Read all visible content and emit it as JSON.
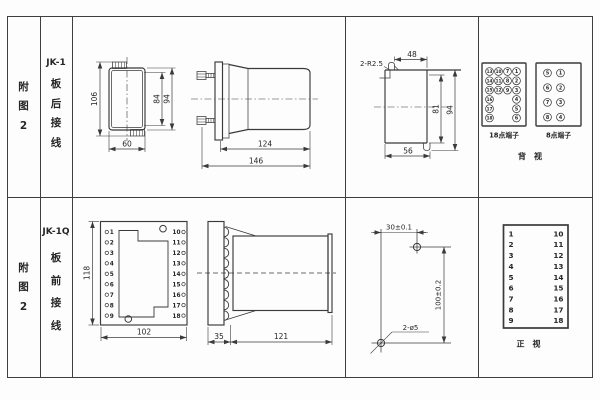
{
  "figure": {
    "row_top": {
      "index_label": [
        "附",
        "图",
        "2"
      ],
      "model": "JK-1",
      "wiring": [
        "板",
        "后",
        "接",
        "线"
      ],
      "rear_view": {
        "dim_total_h": "106",
        "dim_w": "60",
        "dim_inner_h": "84",
        "dim_case_h": "94"
      },
      "side_view": {
        "dim_depth": "124",
        "dim_total": "146"
      },
      "profile": {
        "radius": "2-R2.5",
        "dim_top": "48",
        "dim_inner": "81",
        "dim_outer": "94",
        "dim_bottom": "56"
      },
      "terminal18": {
        "label": "18点端子",
        "col0": [
          "13",
          "14",
          "15",
          "16",
          "17",
          "18"
        ],
        "col1": [
          "10",
          "11",
          "12"
        ],
        "col2": [
          "7",
          "8",
          "9"
        ],
        "col3": [
          "1",
          "2",
          "3",
          "4",
          "5",
          "6"
        ]
      },
      "terminal8": {
        "label": "8点端子",
        "col0": [
          "5",
          "6",
          "7",
          "8"
        ],
        "col1": [
          "1",
          "2",
          "3",
          "4"
        ]
      },
      "view_label": "背　视"
    },
    "row_bottom": {
      "index_label": [
        "附",
        "图",
        "2"
      ],
      "model": "JK-1Q",
      "wiring": [
        "板",
        "前",
        "接",
        "线"
      ],
      "plate": {
        "dim_h": "118",
        "dim_w": "102",
        "left": [
          "1",
          "2",
          "3",
          "4",
          "5",
          "6",
          "7",
          "8",
          "9"
        ],
        "right": [
          "10",
          "11",
          "12",
          "13",
          "14",
          "15",
          "16",
          "17",
          "18"
        ]
      },
      "side_view": {
        "dim_plate": "35",
        "dim_body": "121"
      },
      "drill": {
        "dim_w": "30±0.1",
        "dim_h": "100±0.2",
        "callout": "2-ø5"
      },
      "front_table": {
        "left": [
          "1",
          "2",
          "3",
          "4",
          "5",
          "6",
          "7",
          "8",
          "9"
        ],
        "right": [
          "10",
          "11",
          "12",
          "13",
          "14",
          "15",
          "16",
          "17",
          "18"
        ],
        "view_label": "正　视"
      }
    }
  }
}
